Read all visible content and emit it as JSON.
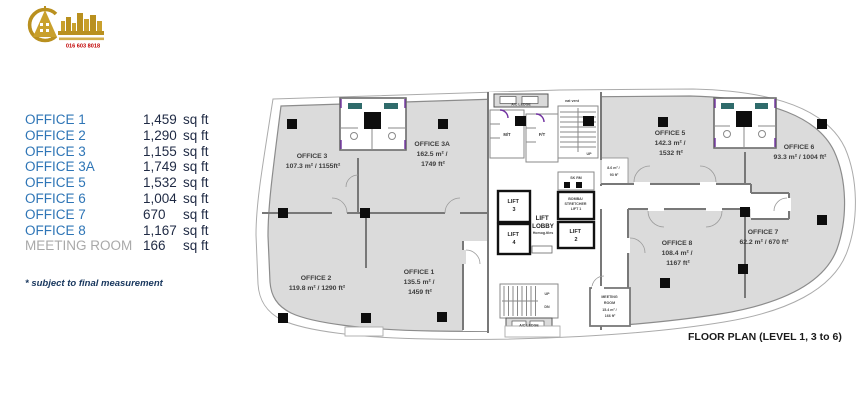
{
  "logo": {
    "phone": "016 603 8018"
  },
  "legend": {
    "items": [
      {
        "label": "OFFICE 1",
        "num": "1,459",
        "unit": "sq ft"
      },
      {
        "label": "OFFICE 2",
        "num": "1,290",
        "unit": "sq ft"
      },
      {
        "label": "OFFICE 3",
        "num": "1,155",
        "unit": "sq ft"
      },
      {
        "label": "OFFICE 3A",
        "num": "1,749",
        "unit": "sq ft"
      },
      {
        "label": "OFFICE 5",
        "num": "1,532",
        "unit": "sq ft"
      },
      {
        "label": "OFFICE 6",
        "num": "1,004",
        "unit": "sq ft"
      },
      {
        "label": "OFFICE 7",
        "num": "670",
        "unit": "sq ft"
      },
      {
        "label": "OFFICE 8",
        "num": "1,167",
        "unit": "sq ft"
      },
      {
        "label": "MEETING ROOM",
        "num": "166",
        "unit": "sq ft"
      }
    ],
    "footnote": "* subject to final measurement"
  },
  "floorplan": {
    "caption": "FLOOR PLAN (LEVEL 1, 3 to 6)",
    "rooms": [
      {
        "name": "OFFICE 3",
        "a1": "107.3 m² / 1155ft²",
        "a2": ""
      },
      {
        "name": "OFFICE 3A",
        "a1": "162.5 m² /",
        "a2": "1749 ft²"
      },
      {
        "name": "OFFICE 5",
        "a1": "142.3 m² /",
        "a2": "1532 ft²"
      },
      {
        "name": "OFFICE 6",
        "a1": "93.3 m² / 1004 ft²",
        "a2": ""
      },
      {
        "name": "OFFICE 7",
        "a1": "62.2 m² / 670 ft²",
        "a2": ""
      },
      {
        "name": "OFFICE 8",
        "a1": "108.4 m² /",
        "a2": "1167 ft²"
      },
      {
        "name": "OFFICE 1",
        "a1": "135.5 m² /",
        "a2": "1459 ft²"
      },
      {
        "name": "OFFICE 2",
        "a1": "119.8 m² / 1290 ft²",
        "a2": ""
      }
    ],
    "core": {
      "mt": "M/T",
      "ftl": "F/T",
      "ac_ledge_top": "A/C LEDGE",
      "nat_vent": "nat vent",
      "up_top": "UP",
      "sk_rm": "SK RM",
      "nook_1": "8.6 m² /",
      "nook_2": "93 ft²",
      "lift3_1": "LIFT",
      "lift3_2": "3",
      "lift4_1": "LIFT",
      "lift4_2": "4",
      "lobby_1": "LIFT",
      "lobby_2": "LOBBY",
      "lobby_3": "Homog.tiles",
      "lift1_1": "BOMBA/",
      "lift1_2": "STRETCHER",
      "lift1_3": "LIFT 1",
      "lift2_1": "LIFT",
      "lift2_2": "2",
      "up_bottom": "UP",
      "dn": "DN",
      "ac_ledge_bottom": "A/C LEDGE",
      "mr_1": "MEETING",
      "mr_2": "ROOM",
      "mr_3": "15.4 m² /",
      "mr_4": "166 ft²"
    }
  },
  "colors": {
    "legend_label": "#2E75B6",
    "legend_value": "#1F2A44",
    "muted": "#A9A9A9",
    "plan_fill": "#DBDBDB",
    "wall": "#787878",
    "logo_gold": "#B9901F",
    "logo_red": "#C00000"
  }
}
